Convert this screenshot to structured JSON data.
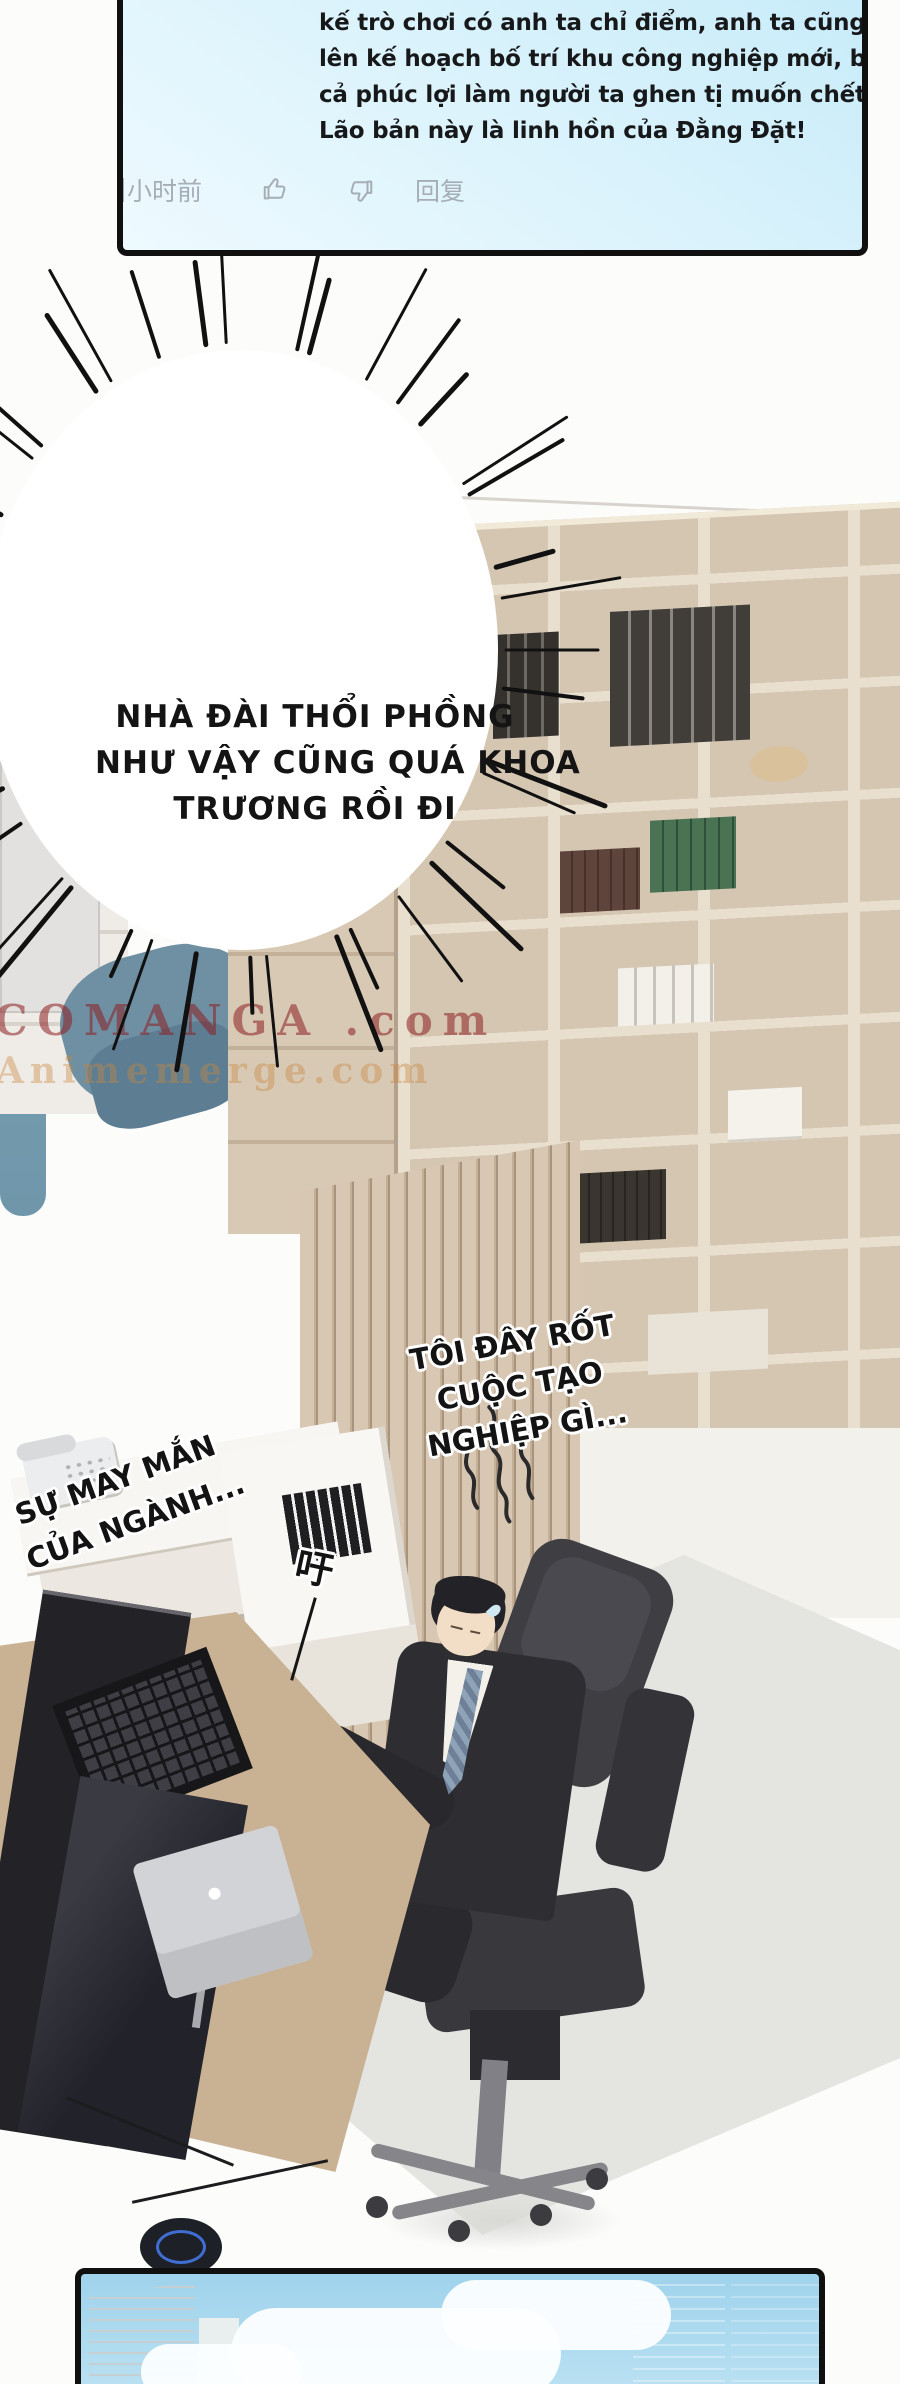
{
  "comment_panel": {
    "lines": [
      "kế trò chơi có anh ta chỉ điểm, anh ta cũng đang",
      "lên kế hoạch bố trí khu công nghiệp mới, bao gồm",
      "cả phúc lợi làm người ta ghen tị muốn chết này.",
      "Lão bản này là linh hồn của Đằng Đặt!"
    ],
    "footer": {
      "timestamp": "小时前",
      "reply_label": "回复"
    },
    "colors": {
      "background_top": "#c6ebf9",
      "background_bottom": "#eefaff",
      "border": "#101010",
      "text": "#17181a",
      "footer_text": "#a7adb4"
    }
  },
  "burst_bubble": {
    "lines": [
      "NHÀ ĐÀI THỔI PHỒNG",
      "NHƯ VẬY CŨNG QUÁ KHOA",
      "TRƯƠNG RỒI ĐI"
    ],
    "text_color": "#141414",
    "bubble_color": "#ffffff",
    "spike_color": "#111111"
  },
  "speech_right": {
    "lines": [
      "TÔI ĐÂY RỐT",
      "CUỘC TẠO",
      "NGHIỆP GÌ..."
    ]
  },
  "speech_left": {
    "lines": [
      "SỰ MAY MẮN",
      "CỦA NGÀNH..."
    ]
  },
  "sfx": {
    "sigh_char": "吁"
  },
  "watermark": {
    "line1": "COMANGA .com",
    "line2": "Animemerge.com",
    "color1": "#8c2022",
    "color2": "#c8873f"
  }
}
